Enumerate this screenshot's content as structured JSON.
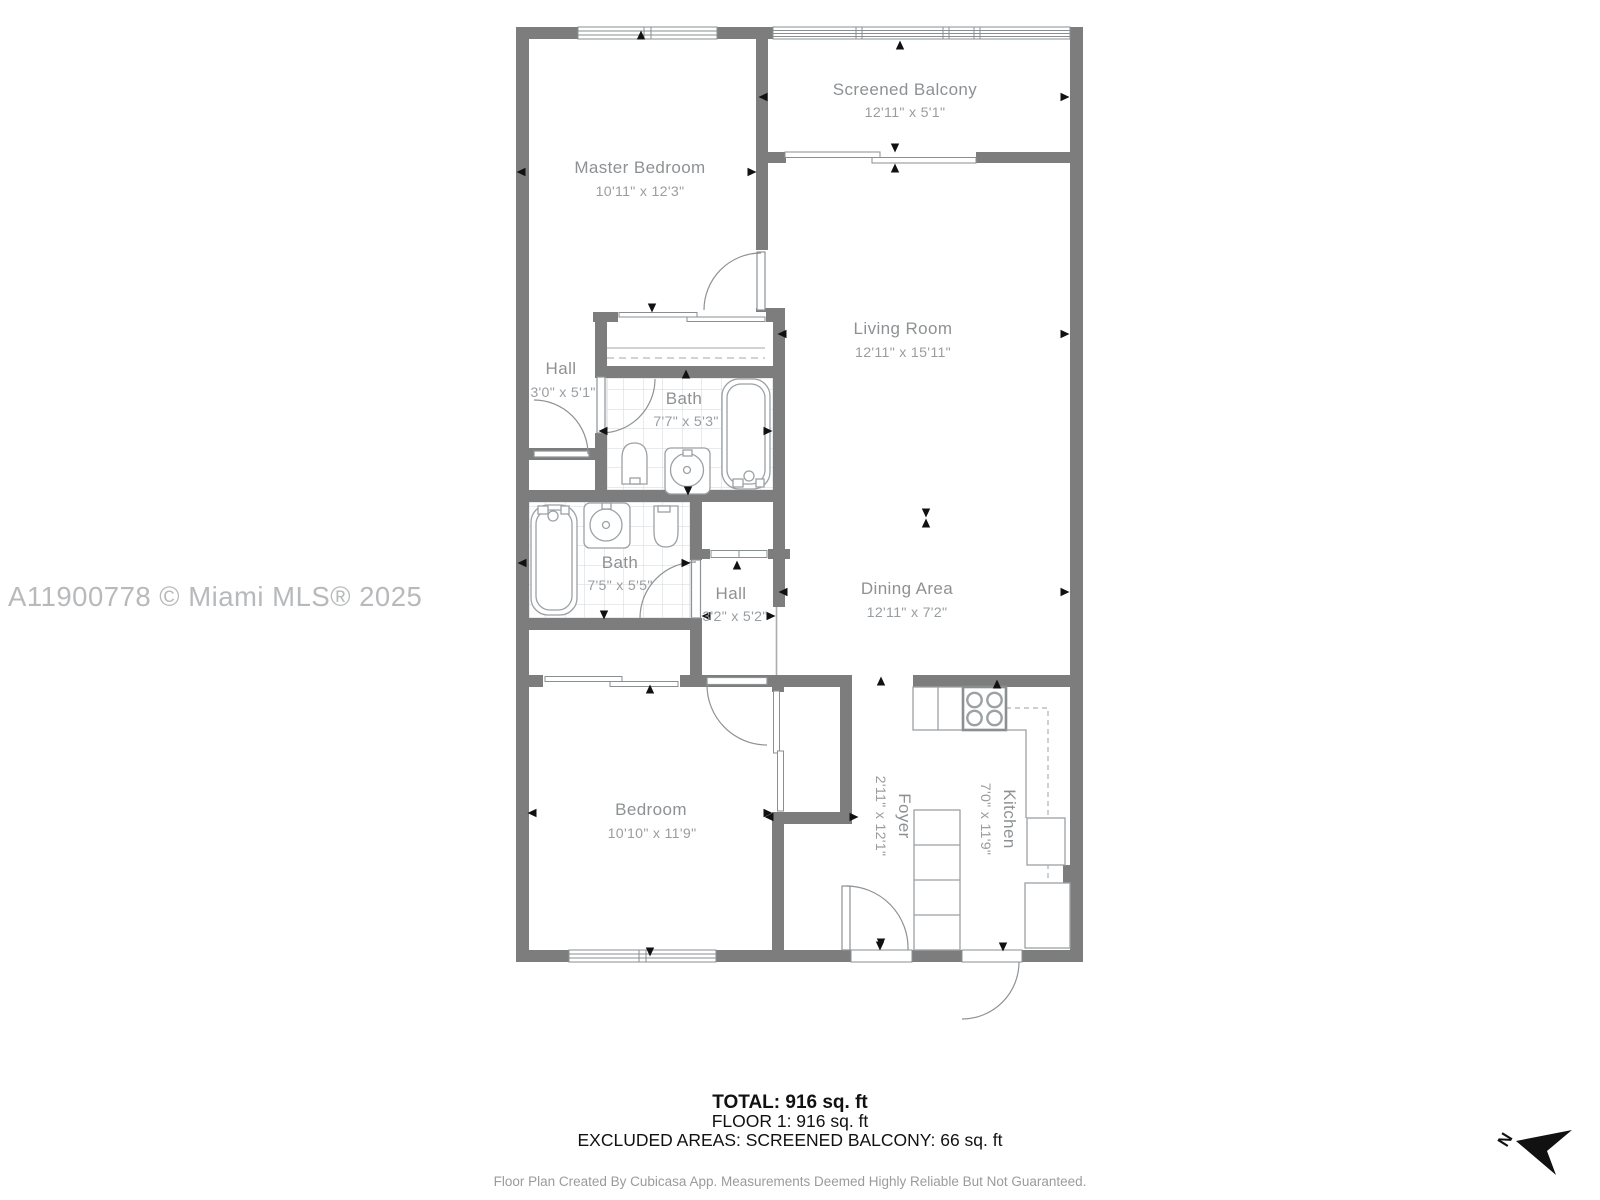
{
  "watermark": "A11900778 © Miami MLS® 2025",
  "compass": {
    "label": "N"
  },
  "rooms": [
    {
      "id": "screened-balcony",
      "name": "Screened Balcony",
      "dims": "12'11\" x 5'1\""
    },
    {
      "id": "master-bedroom",
      "name": "Master Bedroom",
      "dims": "10'11\" x 12'3\""
    },
    {
      "id": "living-room",
      "name": "Living Room",
      "dims": "12'11\" x 15'11\""
    },
    {
      "id": "hall-upper",
      "name": "Hall",
      "dims": "3'0\" x 5'1\""
    },
    {
      "id": "bath-upper",
      "name": "Bath",
      "dims": "7'7\" x 5'3\""
    },
    {
      "id": "bath-lower",
      "name": "Bath",
      "dims": "7'5\" x 5'5\""
    },
    {
      "id": "hall-lower",
      "name": "Hall",
      "dims": "3'2\" x 5'2\""
    },
    {
      "id": "dining-area",
      "name": "Dining Area",
      "dims": "12'11\" x 7'2\""
    },
    {
      "id": "bedroom",
      "name": "Bedroom",
      "dims": "10'10\" x 11'9\""
    },
    {
      "id": "foyer",
      "name": "Foyer",
      "dims": "2'11\" x 12'1\""
    },
    {
      "id": "kitchen",
      "name": "Kitchen",
      "dims": "7'0\" x 11'9\""
    }
  ],
  "summary": {
    "total": "TOTAL: 916 sq. ft",
    "floor": "FLOOR 1: 916 sq. ft",
    "excluded": "EXCLUDED AREAS: SCREENED BALCONY: 66 sq. ft"
  },
  "footer": "Floor Plan Created By Cubicasa App. Measurements Deemed Highly Reliable But Not Guaranteed.",
  "colors": {
    "wall": "#7d7d7d",
    "room_label": "#8e9193",
    "room_dim": "#9a9da0",
    "fixture_line": "#9ba1a4",
    "tile_line": "#d3d5d7",
    "watermark": "#b8b9bb",
    "footer_text": "#9b9b9b",
    "summary_text": "#111111"
  }
}
